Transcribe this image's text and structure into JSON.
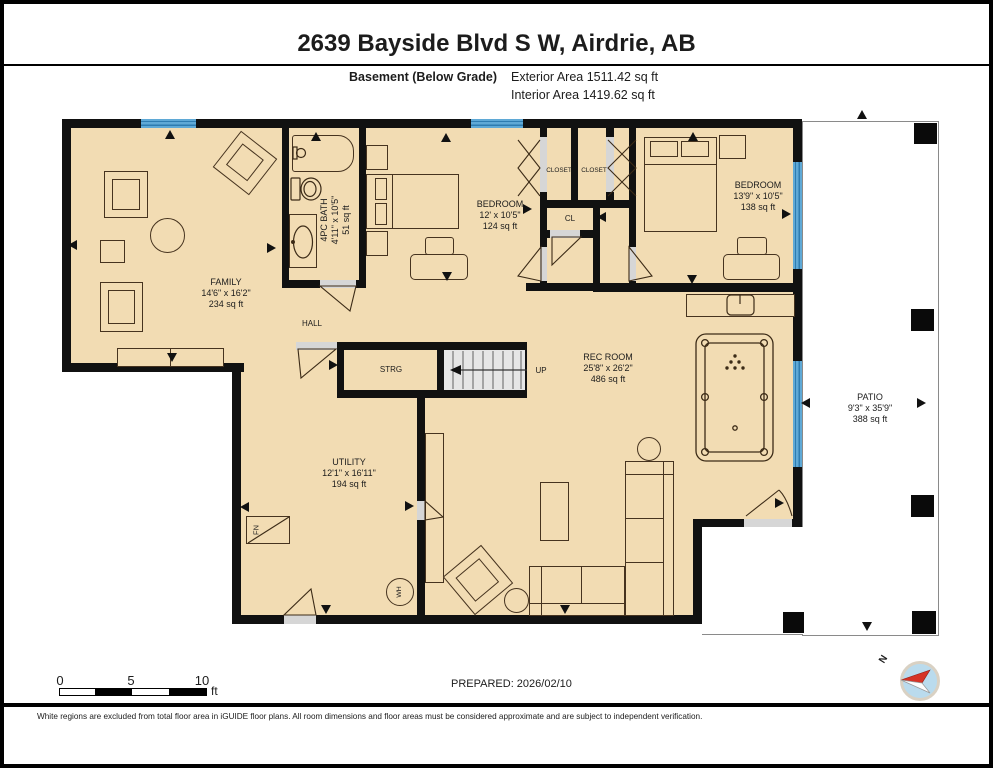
{
  "header": {
    "title": "2639 Bayside Blvd S W, Airdrie, AB",
    "floor_label": "Basement (Below Grade)",
    "exterior_area": "Exterior Area 1511.42 sq ft",
    "interior_area": "Interior Area 1419.62 sq ft"
  },
  "rooms": {
    "family": {
      "name": "FAMILY",
      "dims": "14'6\" x 16'2\"",
      "area": "234 sq ft"
    },
    "bath": {
      "name": "4PC BATH",
      "dims": "4'11\" x 10'5\"",
      "area": "51 sq ft"
    },
    "bedroom1": {
      "name": "BEDROOM",
      "dims": "12' x 10'5\"",
      "area": "124 sq ft"
    },
    "bedroom2": {
      "name": "BEDROOM",
      "dims": "13'9\" x 10'5\"",
      "area": "138 sq ft"
    },
    "rec_room": {
      "name": "REC ROOM",
      "dims": "25'8\" x 26'2\"",
      "area": "486 sq ft"
    },
    "utility": {
      "name": "UTILITY",
      "dims": "12'1\" x 16'11\"",
      "area": "194 sq ft"
    },
    "patio": {
      "name": "PATIO",
      "dims": "9'3\" x 35'9\"",
      "area": "388 sq ft"
    },
    "hall": "HALL",
    "storage": "STRG",
    "stairs_up": "UP",
    "closet_left": "CLOSET",
    "closet_right": "CLOSET",
    "closet_small": "CL",
    "furnace": "FN",
    "water_heater": "WH"
  },
  "scale_bar": {
    "tick0": "0",
    "tick5": "5",
    "tick10": "10",
    "unit": "ft"
  },
  "compass": {
    "north_label": "N"
  },
  "footer": {
    "prepared": "PREPARED: 2026/02/10",
    "disclaimer": "White regions are excluded from total floor area in iGUIDE floor plans. All room dimensions and floor areas must be considered approximate and are subject to independent verification."
  },
  "colors": {
    "floor_fill": "#f2dcb3",
    "wall": "#111111",
    "window": "#5fa9d6",
    "window_stripe": "#2e7cb0",
    "stairs": "#e6e6e6",
    "door_opening": "#d6d6d6",
    "patio_border": "#8a8a8a",
    "compass_fill": "#badbed",
    "compass_needle": "#d63326"
  }
}
